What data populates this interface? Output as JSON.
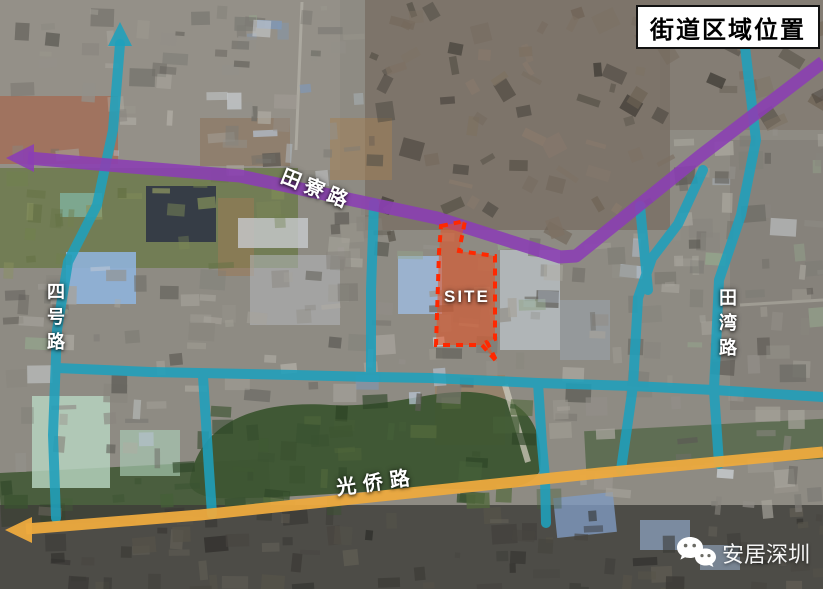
{
  "title": "街道区域位置",
  "map": {
    "type": "satellite-location-map",
    "site": {
      "label": "SITE",
      "fill_color": "#e8501f",
      "border_color": "#ff2800"
    },
    "roads": {
      "network_color": "#1fa0bc",
      "tianliao": {
        "label": "田寮路",
        "color": "#8b3fb2",
        "style": "arterial-purple"
      },
      "sihao": {
        "label": "四号路",
        "color": "#1fa0bc",
        "style": "secondary-teal"
      },
      "tianwan": {
        "label": "田湾路",
        "color": "#1fa0bc",
        "style": "secondary-teal"
      },
      "guangqiao": {
        "label": "光侨路",
        "color": "#edaa3e",
        "style": "arterial-yellow"
      }
    }
  },
  "watermark": {
    "text": "安居深圳",
    "icon": "wechat-icon"
  }
}
